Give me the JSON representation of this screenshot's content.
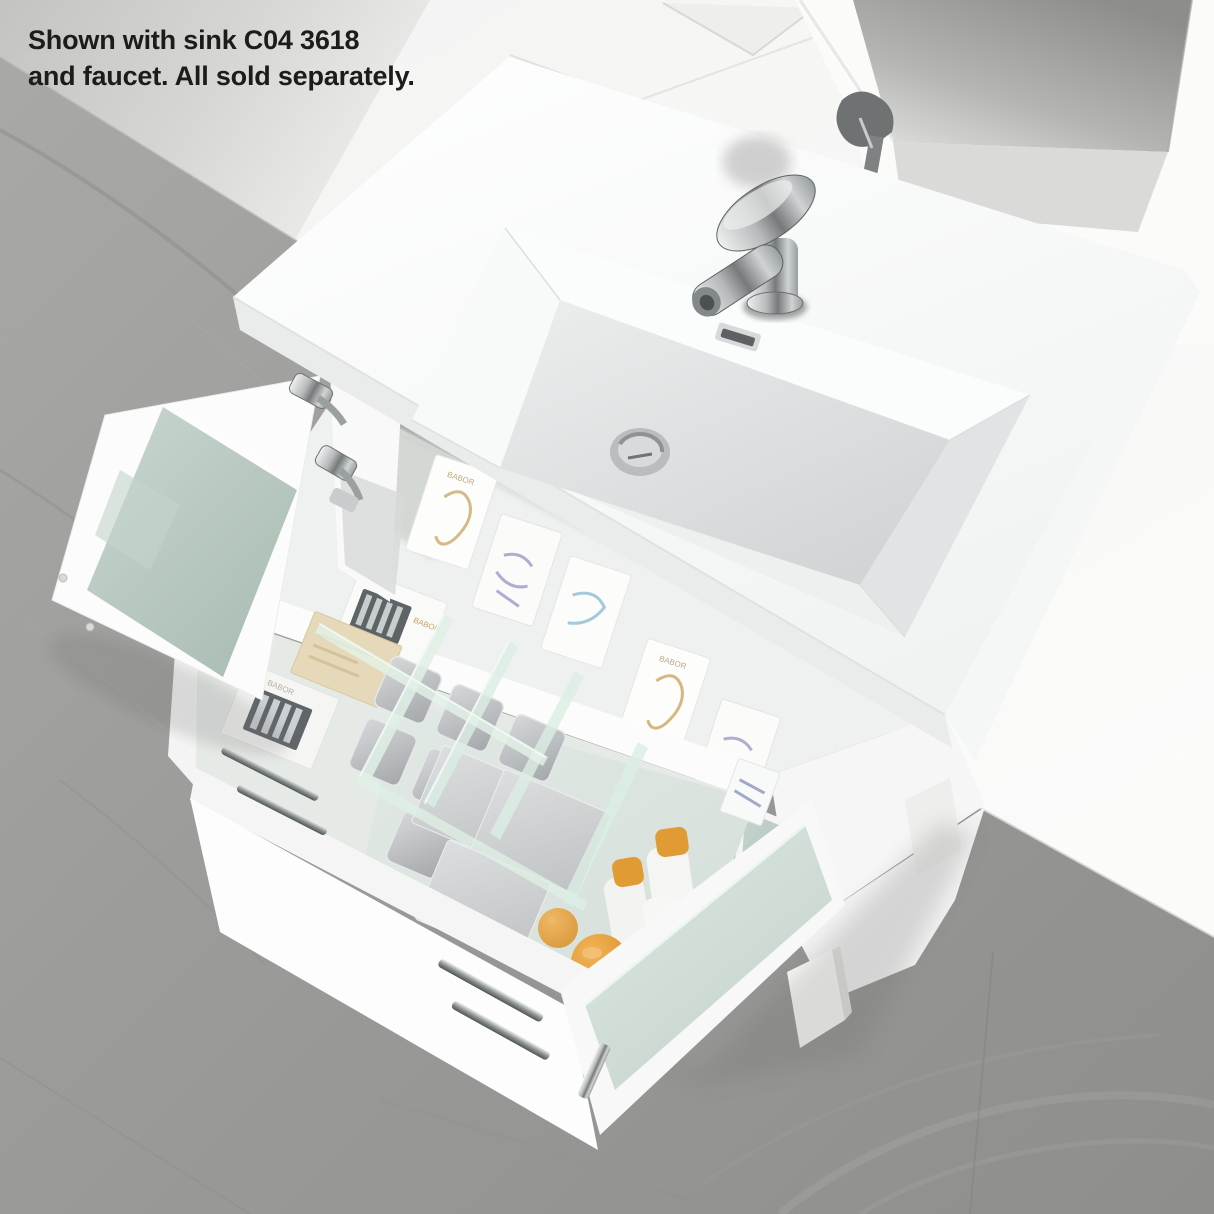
{
  "caption": {
    "line1": "Shown with sink C04 3618",
    "line2": "and faucet. All sold separately."
  },
  "products": {
    "brand": "BABOR"
  },
  "colors": {
    "floor_grey": "#9a9a98",
    "wall_shadow_grey": "#c8c8c7",
    "wall_light": "#f7f7f6",
    "counter_white": "#fcfdfd",
    "frosted_glass_green": "#b9c8c0",
    "drawer_glass_green": "#cfe0d7",
    "chrome": "#9fa4a4",
    "orange_accent": "#e09b35",
    "caption_text": "#1c1c1a"
  }
}
